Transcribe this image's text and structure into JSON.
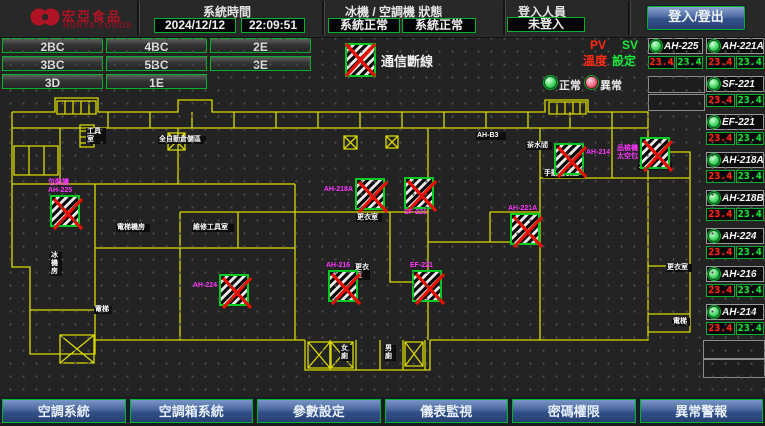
{
  "header": {
    "brand": {
      "name": "宏亞食品",
      "sub": "HUNYA FOODS"
    },
    "system_time": {
      "label": "系統時間",
      "date": "2024/12/12",
      "time": "22:09:51"
    },
    "machine_status": {
      "label": "冰機 / 空調機 狀態",
      "chiller_status": "系統正常",
      "ahu_status": "系統正常"
    },
    "login": {
      "label": "登入人員",
      "status": "未登入",
      "button_label": "登入/登出"
    }
  },
  "floor_nav": {
    "buttons": [
      "2BC",
      "4BC",
      "2E",
      "3BC",
      "5BC",
      "3E",
      "3D",
      "1E"
    ]
  },
  "legend": {
    "comm_fail": "通信斷線",
    "pv": "PV",
    "sv": "SV",
    "temp": "溫度",
    "setting": "設定",
    "normal": "正常",
    "abnormal": "異常"
  },
  "unit_list": {
    "units": [
      {
        "name": "AH-225",
        "pv": "23.4",
        "sv": "23.4",
        "x": 648,
        "y": 38,
        "narrow": true
      },
      {
        "name": "AH-221A",
        "pv": "23.4",
        "sv": "23.4",
        "x": 706,
        "y": 38
      },
      {
        "name": "SF-221",
        "pv": "23.4",
        "sv": "23.4",
        "x": 706,
        "y": 76
      },
      {
        "name": "EF-221",
        "pv": "23.4",
        "sv": "23.4",
        "x": 706,
        "y": 114
      },
      {
        "name": "AH-218A",
        "pv": "23.4",
        "sv": "23.4",
        "x": 706,
        "y": 152
      },
      {
        "name": "AH-218B",
        "pv": "23.4",
        "sv": "23.4",
        "x": 706,
        "y": 190
      },
      {
        "name": "AH-224",
        "pv": "23.4",
        "sv": "23.4",
        "x": 706,
        "y": 228
      },
      {
        "name": "AH-216",
        "pv": "23.4",
        "sv": "23.4",
        "x": 706,
        "y": 266
      },
      {
        "name": "AH-214",
        "pv": "23.4",
        "sv": "23.4",
        "x": 706,
        "y": 304
      }
    ]
  },
  "map": {
    "ahu_markers": [
      {
        "lines": [
          "包裝機",
          "AH-225"
        ],
        "x": 50,
        "y": 103,
        "side": "above"
      },
      {
        "lines": [
          "AH-224"
        ],
        "x": 219,
        "y": 182,
        "side": "left"
      },
      {
        "lines": [
          "AH-218A"
        ],
        "x": 355,
        "y": 86,
        "side": "left"
      },
      {
        "lines": [
          "SF-221"
        ],
        "x": 404,
        "y": 85,
        "side": "below"
      },
      {
        "lines": [
          "AH-216"
        ],
        "x": 328,
        "y": 178,
        "side": "above"
      },
      {
        "lines": [
          "EF-221"
        ],
        "x": 412,
        "y": 178,
        "side": "above"
      },
      {
        "lines": [
          "AH-214"
        ],
        "x": 554,
        "y": 51,
        "side": "right"
      },
      {
        "lines": [
          "品檢機",
          "太空包"
        ],
        "x": 640,
        "y": 45,
        "side": "left"
      },
      {
        "lines": [
          "AH-221A"
        ],
        "x": 510,
        "y": 121,
        "side": "above"
      }
    ],
    "room_labels": [
      {
        "text": "工具室",
        "x": 86,
        "y": 36,
        "w": 18
      },
      {
        "text": "全自動倉儲區",
        "x": 158,
        "y": 44,
        "w": 46
      },
      {
        "text": "AH-B3",
        "x": 476,
        "y": 40,
        "w": 28
      },
      {
        "text": "茶水間",
        "x": 526,
        "y": 50,
        "w": 24
      },
      {
        "text": "手動包裝區",
        "x": 543,
        "y": 78,
        "w": 40
      },
      {
        "text": "太空包區",
        "x": 638,
        "y": 70,
        "w": 32
      },
      {
        "text": "電梯機房",
        "x": 116,
        "y": 132,
        "w": 32
      },
      {
        "text": "維修工具室",
        "x": 192,
        "y": 132,
        "w": 40
      },
      {
        "text": "更衣室",
        "x": 356,
        "y": 122,
        "w": 24
      },
      {
        "text": "更衣室",
        "x": 354,
        "y": 172,
        "w": 14
      },
      {
        "text": "冰機房",
        "x": 50,
        "y": 160,
        "w": 10
      },
      {
        "text": "電梯",
        "x": 94,
        "y": 214,
        "w": 16
      },
      {
        "text": "女廁",
        "x": 340,
        "y": 253,
        "w": 10
      },
      {
        "text": "男廁",
        "x": 384,
        "y": 253,
        "w": 10
      },
      {
        "text": "更衣室",
        "x": 666,
        "y": 172,
        "w": 24
      },
      {
        "text": "電梯",
        "x": 672,
        "y": 226,
        "w": 16
      }
    ]
  },
  "bottom_nav": {
    "buttons": [
      "空調系統",
      "空調箱系統",
      "參數設定",
      "儀表監視",
      "密碼權限",
      "異常警報"
    ]
  }
}
